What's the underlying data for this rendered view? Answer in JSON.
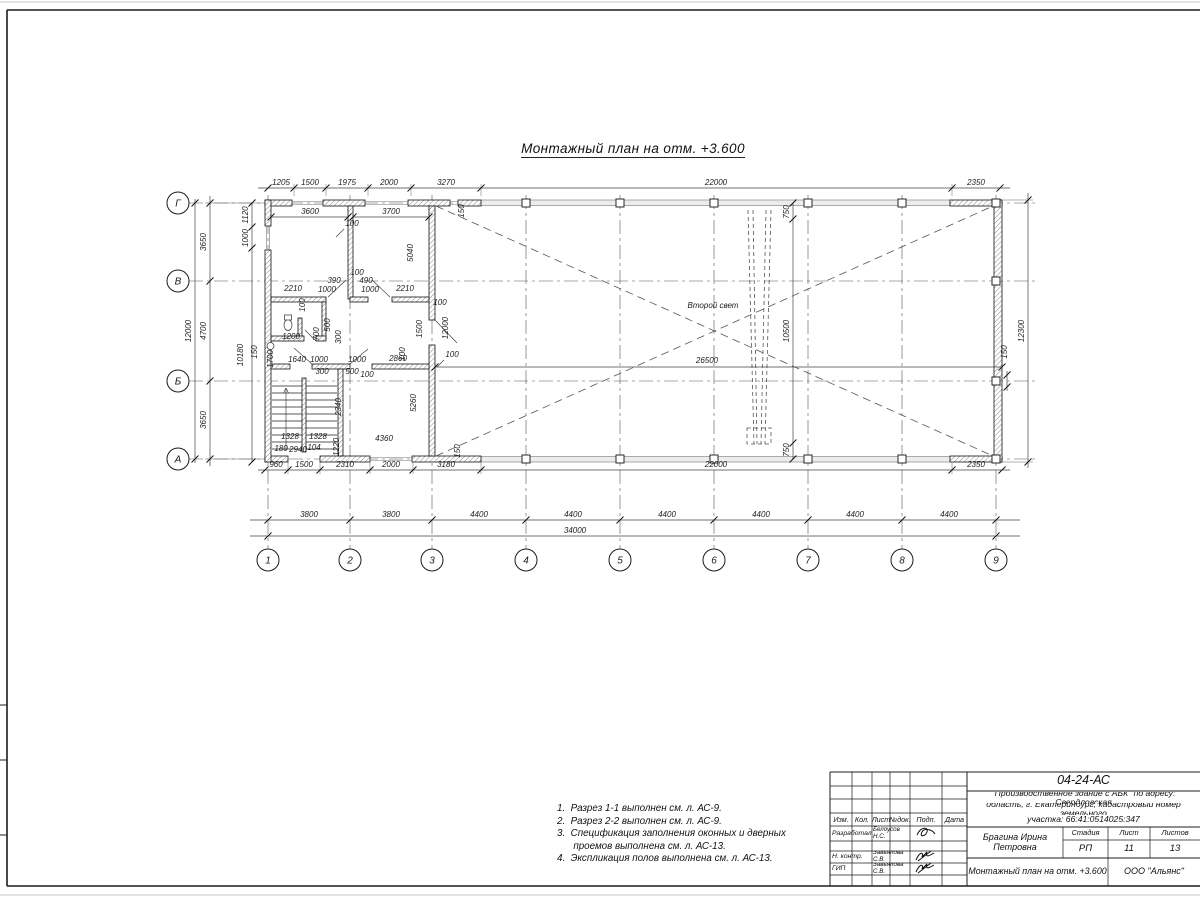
{
  "page": {
    "title": "Монтажный план на отм. +3.600"
  },
  "notes": {
    "lines": [
      "1.  Разрез 1-1 выполнен см. л. АС-9.",
      "2.  Разрез 2-2 выполнен см. л. АС-9.",
      "3.  Спецификация заполнения оконных и дверных",
      "      проемов выполнена см. л. АС-13.",
      "4.  Экспликация полов выполнена см. л. АС-13."
    ]
  },
  "plan": {
    "axes_h": [
      {
        "label": "Г",
        "y": 203
      },
      {
        "label": "В",
        "y": 281
      },
      {
        "label": "Б",
        "y": 381
      },
      {
        "label": "А",
        "y": 459
      }
    ],
    "axes_v": [
      {
        "label": "1",
        "x": 268
      },
      {
        "label": "2",
        "x": 350
      },
      {
        "label": "3",
        "x": 432
      },
      {
        "label": "4",
        "x": 526
      },
      {
        "label": "5",
        "x": 620
      },
      {
        "label": "6",
        "x": 714
      },
      {
        "label": "7",
        "x": 808
      },
      {
        "label": "8",
        "x": 902
      },
      {
        "label": "9",
        "x": 996
      }
    ],
    "labels": [
      {
        "t": "1205",
        "x": 281,
        "y": 185
      },
      {
        "t": "1500",
        "x": 310,
        "y": 185
      },
      {
        "t": "1975",
        "x": 347,
        "y": 185
      },
      {
        "t": "2000",
        "x": 389,
        "y": 185
      },
      {
        "t": "3270",
        "x": 446,
        "y": 185
      },
      {
        "t": "22000",
        "x": 716,
        "y": 185
      },
      {
        "t": "2350",
        "x": 976,
        "y": 185
      },
      {
        "t": "3600",
        "x": 310,
        "y": 214
      },
      {
        "t": "3700",
        "x": 391,
        "y": 214
      },
      {
        "t": "960",
        "x": 276,
        "y": 467
      },
      {
        "t": "1500",
        "x": 304,
        "y": 467
      },
      {
        "t": "2310",
        "x": 345,
        "y": 467
      },
      {
        "t": "2000",
        "x": 391,
        "y": 467
      },
      {
        "t": "3180",
        "x": 446,
        "y": 467
      },
      {
        "t": "22000",
        "x": 716,
        "y": 467
      },
      {
        "t": "2350",
        "x": 976,
        "y": 467
      },
      {
        "t": "3800",
        "x": 309,
        "y": 517
      },
      {
        "t": "3800",
        "x": 391,
        "y": 517
      },
      {
        "t": "4400",
        "x": 479,
        "y": 517
      },
      {
        "t": "4400",
        "x": 573,
        "y": 517
      },
      {
        "t": "4400",
        "x": 667,
        "y": 517
      },
      {
        "t": "4400",
        "x": 761,
        "y": 517
      },
      {
        "t": "4400",
        "x": 855,
        "y": 517
      },
      {
        "t": "4400",
        "x": 949,
        "y": 517
      },
      {
        "t": "34000",
        "x": 575,
        "y": 533
      },
      {
        "t": "3650",
        "x": 206,
        "y": 242,
        "r": 1
      },
      {
        "t": "4700",
        "x": 206,
        "y": 331,
        "r": 1
      },
      {
        "t": "3650",
        "x": 206,
        "y": 420,
        "r": 1
      },
      {
        "t": "12000",
        "x": 191,
        "y": 331,
        "r": 1
      },
      {
        "t": "1120",
        "x": 248,
        "y": 215,
        "r": 1
      },
      {
        "t": "1000",
        "x": 248,
        "y": 238,
        "r": 1
      },
      {
        "t": "10180",
        "x": 243,
        "y": 355,
        "r": 1
      },
      {
        "t": "150",
        "x": 257,
        "y": 352,
        "r": 1
      },
      {
        "t": "1700",
        "x": 273,
        "y": 359,
        "r": 1
      },
      {
        "t": "12300",
        "x": 1024,
        "y": 331,
        "r": 1
      },
      {
        "t": "150",
        "x": 1007,
        "y": 352,
        "r": 1
      },
      {
        "t": "750",
        "x": 789,
        "y": 212,
        "r": 1
      },
      {
        "t": "10500",
        "x": 789,
        "y": 331,
        "r": 1
      },
      {
        "t": "750",
        "x": 789,
        "y": 450,
        "r": 1
      },
      {
        "t": "26500",
        "x": 707,
        "y": 363
      },
      {
        "t": "100",
        "x": 452,
        "y": 357
      },
      {
        "t": "150",
        "x": 464,
        "y": 211,
        "r": 1
      },
      {
        "t": "150",
        "x": 460,
        "y": 451,
        "r": 1
      },
      {
        "t": "100",
        "x": 352,
        "y": 226
      },
      {
        "t": "5040",
        "x": 413,
        "y": 253,
        "r": 1
      },
      {
        "t": "2210",
        "x": 293,
        "y": 291
      },
      {
        "t": "390",
        "x": 334,
        "y": 283
      },
      {
        "t": "1000",
        "x": 327,
        "y": 292
      },
      {
        "t": "100",
        "x": 357,
        "y": 275
      },
      {
        "t": "490",
        "x": 366,
        "y": 283
      },
      {
        "t": "1000",
        "x": 370,
        "y": 292
      },
      {
        "t": "2210",
        "x": 405,
        "y": 291
      },
      {
        "t": "100",
        "x": 440,
        "y": 305
      },
      {
        "t": "100",
        "x": 305,
        "y": 305,
        "r": 1
      },
      {
        "t": "1200",
        "x": 291,
        "y": 339
      },
      {
        "t": "500",
        "x": 330,
        "y": 325,
        "r": 1
      },
      {
        "t": "700",
        "x": 319,
        "y": 334,
        "r": 1
      },
      {
        "t": "300",
        "x": 341,
        "y": 337,
        "r": 1
      },
      {
        "t": "1500",
        "x": 422,
        "y": 329,
        "r": 1
      },
      {
        "t": "12000",
        "x": 448,
        "y": 328,
        "r": 1
      },
      {
        "t": "1640",
        "x": 297,
        "y": 362
      },
      {
        "t": "1000",
        "x": 319,
        "y": 362
      },
      {
        "t": "300",
        "x": 322,
        "y": 374
      },
      {
        "t": "1000",
        "x": 357,
        "y": 362
      },
      {
        "t": "500",
        "x": 352,
        "y": 374
      },
      {
        "t": "100",
        "x": 367,
        "y": 377
      },
      {
        "t": "2860",
        "x": 398,
        "y": 361
      },
      {
        "t": "100",
        "x": 405,
        "y": 354,
        "r": 1
      },
      {
        "t": "2340",
        "x": 341,
        "y": 407,
        "r": 1
      },
      {
        "t": "5260",
        "x": 416,
        "y": 403,
        "r": 1
      },
      {
        "t": "4360",
        "x": 384,
        "y": 441
      },
      {
        "t": "1328",
        "x": 290,
        "y": 439
      },
      {
        "t": "1328",
        "x": 318,
        "y": 439
      },
      {
        "t": "180",
        "x": 281,
        "y": 451
      },
      {
        "t": "2940",
        "x": 298,
        "y": 452
      },
      {
        "t": "104",
        "x": 314,
        "y": 450
      },
      {
        "t": "1220",
        "x": 339,
        "y": 447,
        "r": 1
      },
      {
        "t": "Второй свет",
        "x": 713,
        "y": 308,
        "s": 9.5,
        "n": "second-light-label"
      }
    ]
  },
  "title_block": {
    "code": "04-24-АС",
    "project": [
      "\"Производственное здание с АБК\" по адресу: Свердловская",
      "область, г. Екатеринбург, кадастровый номер земельного",
      "участка: 66:41:0514025:347"
    ],
    "author": "Брагина Ирина Петровна",
    "sheet_title": "Монтажный план на отм. +3.600",
    "org": "ООО \"Альянс\"",
    "cols": [
      "Изм.",
      "Кол.",
      "Лист",
      "№док.",
      "Подп.",
      "Дата"
    ],
    "stage_headers": [
      "Стадия",
      "Лист",
      "Листов"
    ],
    "stage_values": [
      "РП",
      "11",
      "13"
    ],
    "rows": [
      {
        "role": "Разработал",
        "name": "Белоусов Н.С."
      },
      {
        "role": "Н. контр.",
        "name": "Завьялова С.В."
      },
      {
        "role": "ГИП",
        "name": "Завьялова С.В."
      }
    ]
  }
}
